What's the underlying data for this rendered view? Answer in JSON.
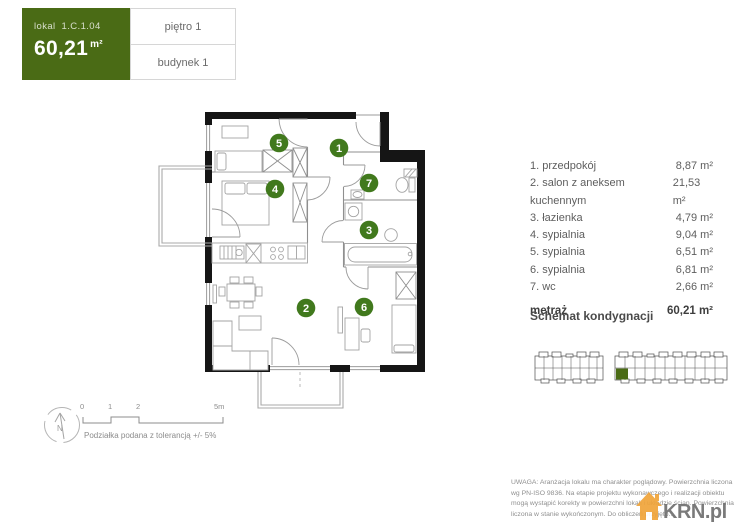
{
  "header": {
    "unit_label": "lokal",
    "unit_number": "1.C.1.04",
    "area_value": "60,21",
    "area_unit": "m²",
    "floor": "piętro 1",
    "building": "budynek 1"
  },
  "rooms": [
    {
      "number": "1",
      "label": "1. przedpokój",
      "area": "8,87 m²"
    },
    {
      "number": "2",
      "label": "2. salon z aneksem kuchennym",
      "area": "21,53 m²"
    },
    {
      "number": "3",
      "label": "3. łazienka",
      "area": "4,79 m²"
    },
    {
      "number": "4",
      "label": "4. sypialnia",
      "area": "9,04 m²"
    },
    {
      "number": "5",
      "label": "5. sypialnia",
      "area": "6,51 m²"
    },
    {
      "number": "6",
      "label": "6. sypialnia",
      "area": "6,81 m²"
    },
    {
      "number": "7",
      "label": "7. wc",
      "area": "2,66 m²"
    }
  ],
  "total": {
    "label": "metraż",
    "area": "60,21 m²"
  },
  "schematic_title": "Schemat kondygnacji",
  "scale_bar": {
    "ticks": [
      "0",
      "1",
      "2",
      "5m"
    ],
    "note": "Podziałka podana z tolerancją +/- 5%"
  },
  "compass": {
    "letter": "N"
  },
  "disclaimer": {
    "line1": "UWAGA: Aranżacja lokalu ma charakter poglądowy. Powierzchnia liczona",
    "line2": "wg PN-ISO 9836. Na etapie projektu wykonawczego i realizacji obiektu",
    "line3": "mogą wystąpić korekty w powierzchni lokali i układzie ścian. Powierzchnia",
    "line4": "liczona w stanie wykończonym. Do obliczeń przyjęto..."
  },
  "logo": {
    "text": "KRN.pl"
  },
  "colors": {
    "accent_green": "#4a6b15",
    "badge_green": "#41791d",
    "logo_orange": "#f0a43a",
    "wall_black": "#151515"
  }
}
